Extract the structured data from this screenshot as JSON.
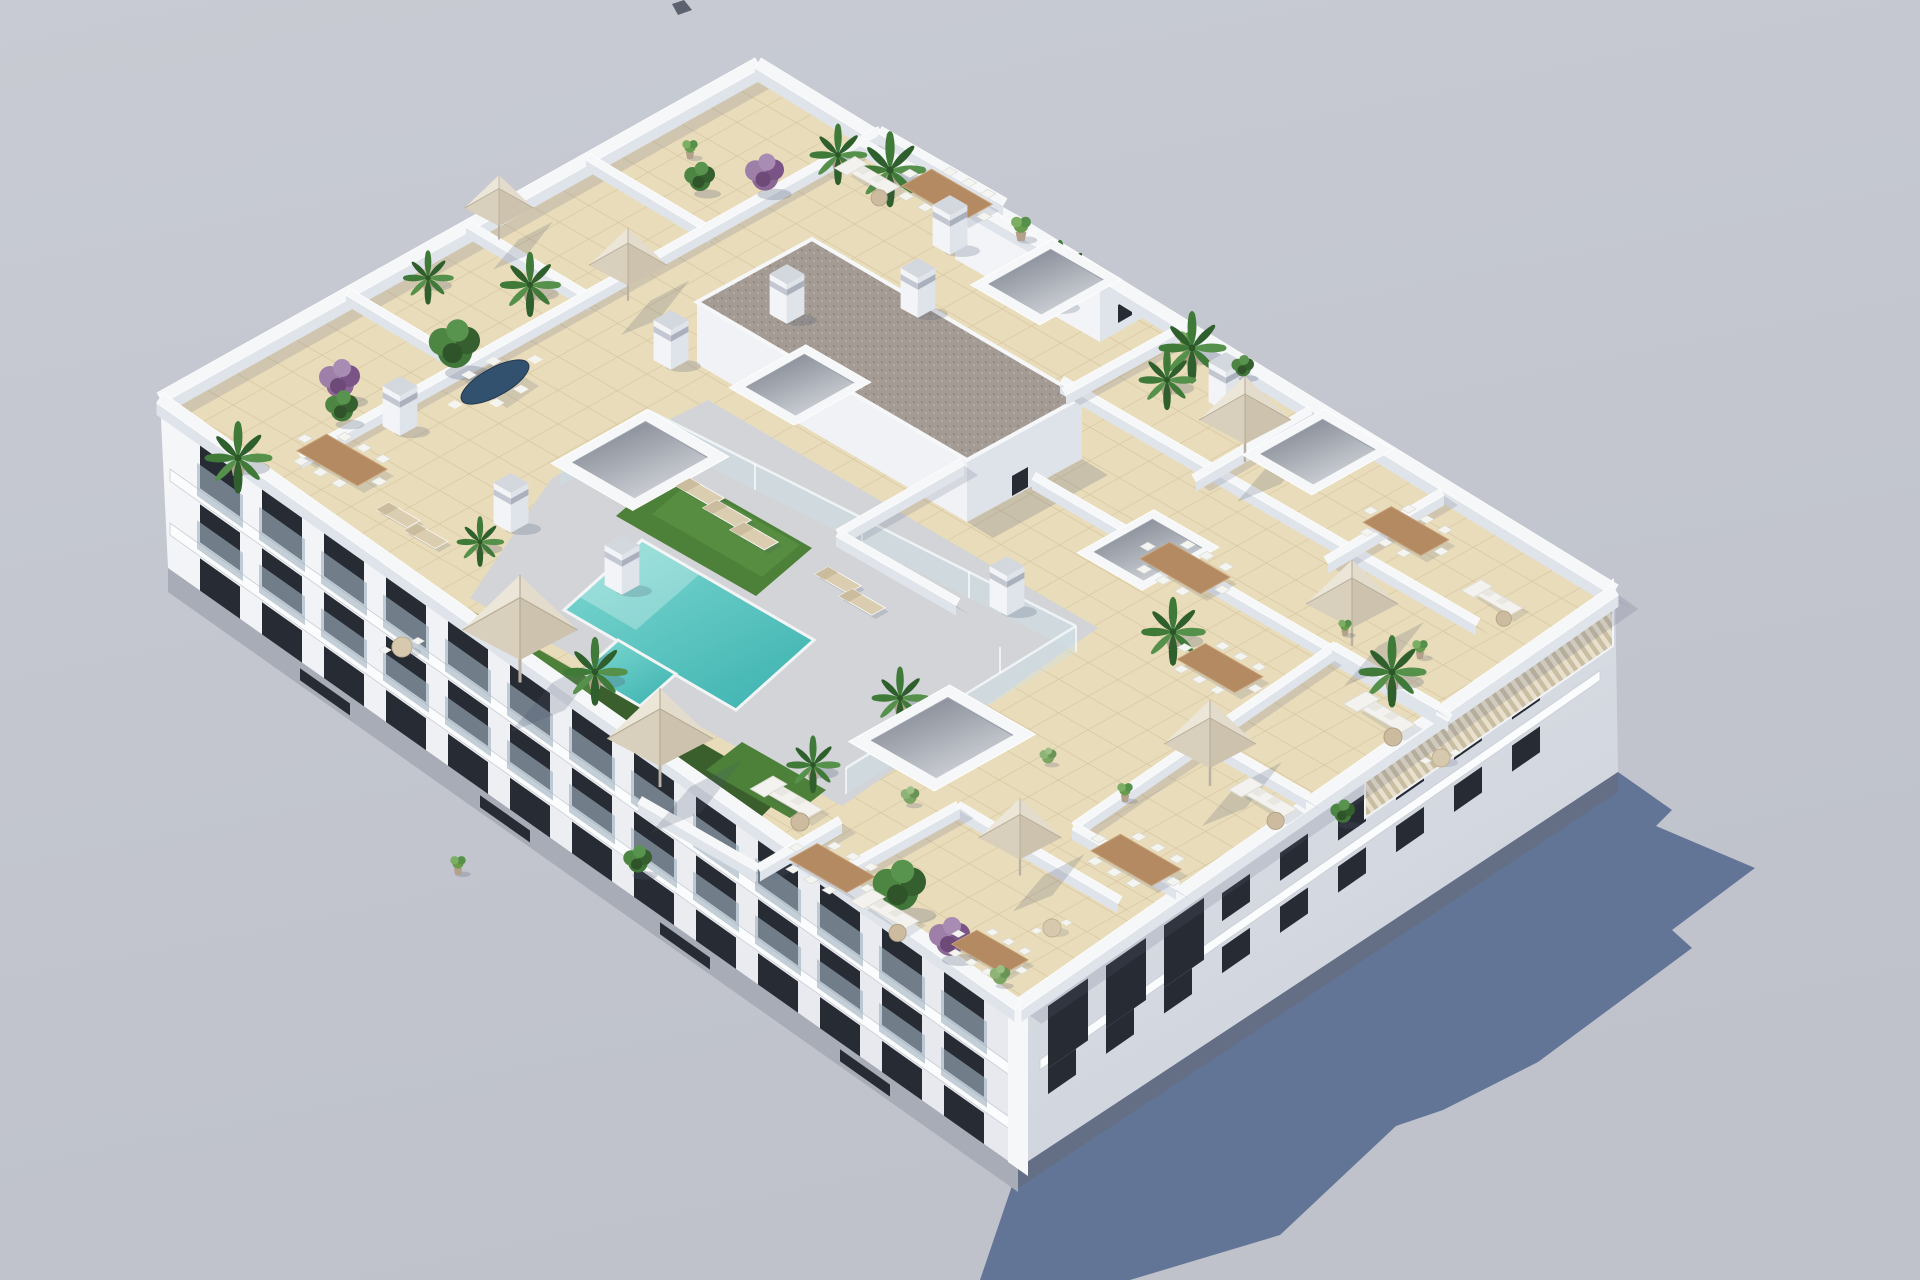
{
  "scene": {
    "description": "Aerial 3D render of a white apartment block with landscaped roof terraces, communal pool, umbrellas and patio furniture, casting a shadow to the lower right",
    "building": "white-apartment-block",
    "rooftop_features": [
      "tiled terraces",
      "swimming pool",
      "artificial grass",
      "glass pool fence",
      "stair core with gravel roof",
      "skylights",
      "chimney pillars",
      "louvered pergola",
      "patio umbrellas",
      "dining sets",
      "sofa sets",
      "sun loungers",
      "palms",
      "shrubs",
      "bougainvillea"
    ],
    "parapet": [
      [
        160,
        398,
        758,
        63
      ],
      [
        758,
        63,
        1615,
        590
      ],
      [
        1615,
        590,
        1018,
        1005
      ],
      [
        1018,
        1005,
        160,
        398
      ]
    ],
    "walls": [
      [
        348,
        292,
        472,
        366
      ],
      [
        468,
        224,
        592,
        298
      ],
      [
        588,
        157,
        712,
        231
      ],
      [
        300,
        455,
        880,
        130
      ],
      [
        880,
        130,
        1005,
        202
      ],
      [
        862,
        142,
        1082,
        268
      ],
      [
        1062,
        380,
        1478,
        622
      ],
      [
        1180,
        328,
        1064,
        392
      ],
      [
        1310,
        410,
        1194,
        478
      ],
      [
        1442,
        492,
        1326,
        560
      ],
      [
        1034,
        476,
        1450,
        718
      ],
      [
        1074,
        826,
        1336,
        645
      ],
      [
        1178,
        886,
        1074,
        826
      ],
      [
        1308,
        796,
        1204,
        736
      ],
      [
        1438,
        706,
        1334,
        646
      ],
      [
        962,
        462,
        838,
        533
      ],
      [
        838,
        533,
        958,
        602
      ],
      [
        958,
        805,
        1120,
        900
      ],
      [
        838,
        872,
        958,
        805
      ],
      [
        640,
        800,
        758,
        868
      ],
      [
        758,
        868,
        840,
        820
      ]
    ],
    "facade_sw": {
      "x0": 160,
      "y0": 398,
      "slope": 0.7076,
      "bays": 13,
      "bx0": 200,
      "bdx": 62,
      "bw": 40,
      "rows": [
        {
          "dy": 18,
          "h": 44,
          "glass": true
        },
        {
          "dy": 78,
          "h": 38,
          "glass": true
        },
        {
          "dy": 132,
          "h": 36,
          "glass": false
        }
      ],
      "bands": [
        [
          64,
          76
        ],
        [
          118,
          130
        ]
      ],
      "xa": 170,
      "xb": 1012
    },
    "facade_se": {
      "x0": 1018,
      "y0": 1005,
      "slope": -0.695,
      "bays": 9,
      "bx0": 1048,
      "bdx": 58,
      "bw": 28,
      "rows": [
        {
          "dy": 30,
          "h": 28
        },
        {
          "dy": 84,
          "h": 26
        }
      ],
      "bands": [
        [
          70,
          80
        ]
      ],
      "xa": 1040,
      "xb": 1600,
      "niches": 3
    },
    "objects": {
      "skylights": [
        [
          1046,
          282,
          0.85
        ],
        [
          800,
          385,
          0.8
        ],
        [
          640,
          460,
          1.0
        ],
        [
          1318,
          452,
          0.85
        ],
        [
          1148,
          550,
          0.8
        ],
        [
          942,
          738,
          1.05
        ]
      ],
      "pillars": [
        [
          950,
          205,
          1
        ],
        [
          1050,
          262,
          1
        ],
        [
          918,
          268,
          1
        ],
        [
          787,
          274,
          1
        ],
        [
          671,
          320,
          1
        ],
        [
          1007,
          566,
          1
        ],
        [
          511,
          483,
          1
        ],
        [
          400,
          386,
          1
        ],
        [
          1226,
          362,
          1
        ],
        [
          622,
          545,
          1
        ]
      ],
      "umbrellas": [
        [
          499,
          214,
          0.75
        ],
        [
          628,
          272,
          0.85
        ],
        [
          520,
          640,
          1.25
        ],
        [
          660,
          748,
          1.15
        ],
        [
          1245,
          428,
          1.0
        ],
        [
          1352,
          612,
          1.0
        ],
        [
          1210,
          752,
          1.0
        ],
        [
          1020,
          845,
          0.9
        ]
      ],
      "palms": [
        [
          238,
          458,
          1.0
        ],
        [
          890,
          170,
          1.05
        ],
        [
          838,
          155,
          0.85
        ],
        [
          1060,
          275,
          0.95
        ],
        [
          1192,
          348,
          1.0
        ],
        [
          1167,
          380,
          0.85
        ],
        [
          1173,
          632,
          0.95
        ],
        [
          1392,
          672,
          1.0
        ],
        [
          595,
          672,
          0.95
        ],
        [
          480,
          542,
          0.7
        ],
        [
          813,
          765,
          0.8
        ],
        [
          428,
          278,
          0.75
        ],
        [
          530,
          285,
          0.9
        ],
        [
          900,
          698,
          0.85
        ]
      ],
      "bushes": [
        [
          455,
          358,
          1.25
        ],
        [
          900,
          900,
          1.3
        ],
        [
          700,
          185,
          0.75
        ],
        [
          1243,
          372,
          0.55
        ],
        [
          1343,
          818,
          0.6
        ],
        [
          638,
          867,
          0.7
        ],
        [
          342,
          415,
          0.8
        ]
      ],
      "light_bushes": [
        [
          1000,
          980,
          0.6
        ],
        [
          1048,
          760,
          0.5
        ],
        [
          910,
          800,
          0.55
        ]
      ],
      "purple_shrubs": [
        [
          340,
          390,
          1.0
        ],
        [
          765,
          183,
          0.95
        ],
        [
          950,
          948,
          1.0
        ]
      ],
      "potted_plants": [
        [
          1021,
          232,
          0.9
        ],
        [
          1186,
          345,
          0.8
        ],
        [
          1125,
          795,
          0.7
        ],
        [
          1420,
          652,
          0.7
        ],
        [
          458,
          868,
          0.7
        ],
        [
          690,
          152,
          0.7
        ],
        [
          1345,
          630,
          0.6
        ]
      ],
      "dining_sets": [
        [
          947,
          195,
          1.0
        ],
        [
          342,
          460,
          1.0
        ],
        [
          1185,
          568,
          1.0
        ],
        [
          1406,
          531,
          0.95
        ],
        [
          1220,
          668,
          0.95
        ],
        [
          1136,
          860,
          1.0
        ],
        [
          832,
          868,
          0.95
        ],
        [
          990,
          952,
          0.85
        ]
      ],
      "navy_tables": [
        [
          495,
          382,
          1.0
        ]
      ],
      "sofa_sets": [
        [
          872,
          178,
          0.9
        ],
        [
          792,
          800,
          1.0
        ],
        [
          890,
          912,
          0.95
        ],
        [
          1385,
          715,
          1.0
        ],
        [
          1268,
          800,
          0.95
        ],
        [
          1497,
          600,
          0.85
        ]
      ],
      "loungers": [
        [
          700,
          492,
          1
        ],
        [
          727,
          514,
          1
        ],
        [
          754,
          536,
          1
        ],
        [
          838,
          580,
          0.95
        ],
        [
          862,
          602,
          0.95
        ],
        [
          398,
          515,
          0.9
        ],
        [
          426,
          536,
          0.9
        ]
      ],
      "round_tables": [
        [
          402,
          647,
          1
        ],
        [
          1441,
          758,
          0.9
        ],
        [
          1052,
          928,
          0.9
        ]
      ]
    }
  },
  "colors": {
    "background": "#c3c6cf",
    "backgroundTop": "#c7cad2",
    "castShadow": "#5e7194",
    "speck": "#414757",
    "facade": "#f2f3f6",
    "facadeShade": "#dcdfe6",
    "facadeBase": "#a7acb6",
    "facadeBaseDark": "#646f86",
    "windowGlass": "#272b33",
    "balconyGlass": "#9fb2c0",
    "parapet": "#f6f7f9",
    "parapetFace": "#dfe3ea",
    "wallShadow": "rgba(96,102,128,0.18)",
    "tile": "#e9dcba",
    "tileLine": "#d6c6a0",
    "deck": "#d2d4d8",
    "pool": "#56c6c2",
    "poolLight": "#7fd8d2",
    "poolDark": "#3fb2af",
    "grass": "#4d8139",
    "grassLight": "#5f9747",
    "hedge": "#3a5f2d",
    "gravel": "#a49b94",
    "umbrella": "#d9d0bf",
    "umbrellaShade": "#cdc2ae",
    "wood": "#b38a61",
    "navyTable": "#31516f",
    "sofa": "#f3f2ee",
    "lounger": "#dbcdaf",
    "plantGreen": "#41763a",
    "plantDark": "#2f5a2b",
    "plantLight": "#6a9c50",
    "purple": "#8b6795",
    "pot": "#b3a18c",
    "objShadow": "rgba(74,86,112,0.28)"
  }
}
